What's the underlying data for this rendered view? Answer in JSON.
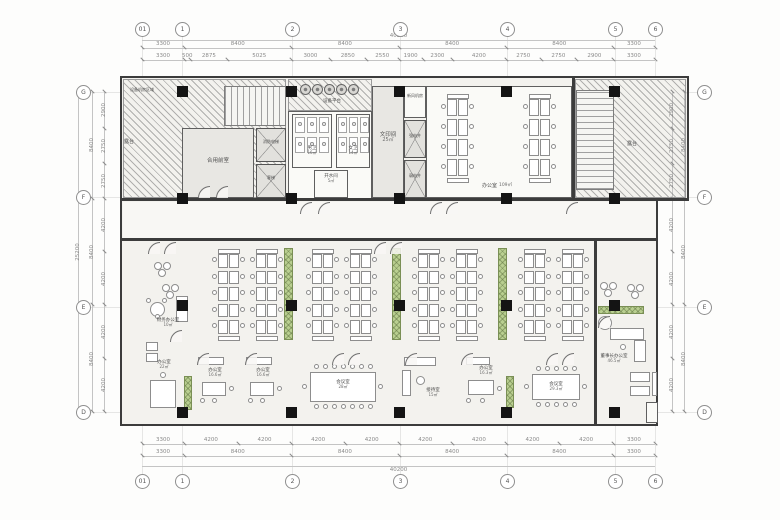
{
  "drawing": {
    "type_label": "办公平面布置图"
  },
  "grid": {
    "cols_labels": [
      "01",
      "1",
      "2",
      "3",
      "4",
      "5",
      "6"
    ],
    "rows_labels": [
      "G",
      "F",
      "E",
      "D"
    ]
  },
  "dims": {
    "overall_h": "40200",
    "overall_v": "25200",
    "top_spans": [
      "3300",
      "8400",
      "8400",
      "8400",
      "8400",
      "3300"
    ],
    "top_details": [
      "3300",
      "500",
      "2875",
      "5025",
      "3000",
      "2850",
      "2550",
      "1900",
      "2300",
      "4200",
      "2750",
      "2750",
      "2900",
      "3300"
    ],
    "bottom_spans": [
      "3300",
      "8400",
      "8400",
      "8400",
      "8400",
      "3300"
    ],
    "bottom_details": [
      "3300",
      "4200",
      "4200",
      "4200",
      "4200",
      "4200",
      "4200",
      "4200",
      "4200",
      "3300"
    ],
    "left_spans": [
      "8400",
      "8400",
      "8400"
    ],
    "left_details": [
      "2900",
      "2750",
      "2750",
      "4200",
      "4200",
      "4200",
      "4200"
    ],
    "right_spans": [
      "8400",
      "8400",
      "8400"
    ],
    "right_details": [
      "2900",
      "2750",
      "2750",
      "4200",
      "4200",
      "4200",
      "4200"
    ]
  },
  "rooms": {
    "shared_front": {
      "name": "合用前室",
      "area": "32㎡"
    },
    "terrace_left": {
      "name": "露台"
    },
    "terrace_right": {
      "name": "露台"
    },
    "equip_zone": {
      "name": "设备机房区域"
    },
    "equip_platform": {
      "name": "设备平台"
    },
    "mens_wc": {
      "name": "男卫",
      "area": "16㎡"
    },
    "womens_wc": {
      "name": "女卫",
      "area": "14㎡"
    },
    "water_room": {
      "name": "开水间",
      "area": "5㎡"
    },
    "print_room": {
      "name": "文印间",
      "area": "25㎡"
    },
    "fresh_air": {
      "name": "新风机房"
    },
    "strong_shaft": {
      "name": "强电井"
    },
    "weak_shaft": {
      "name": "弱电井"
    },
    "elevator_fire": {
      "name": "消防电梯"
    },
    "elevator_passenger": {
      "name": "客梯"
    },
    "office_top": {
      "name": "办公室",
      "area": "109㎡"
    },
    "finance_office": {
      "name": "财务办公室",
      "area": "10㎡"
    },
    "office_22": {
      "name": "办公室",
      "area": "22㎡"
    },
    "office_166a": {
      "name": "办公室",
      "area": "16.6㎡"
    },
    "office_166b": {
      "name": "办公室",
      "area": "16.6㎡"
    },
    "meeting_28": {
      "name": "会议室",
      "area": "28㎡"
    },
    "reception": {
      "name": "接待室",
      "area": "15㎡"
    },
    "office_163": {
      "name": "办公室",
      "area": "16.3㎡"
    },
    "meeting_293": {
      "name": "会议室",
      "area": "29.3㎡"
    },
    "chairman_office": {
      "name": "董事长办公室",
      "area": "46.5㎡"
    }
  },
  "colors": {
    "glass_teal": "#2e99a1",
    "meeting_blue": "#9dc7ce",
    "wood_floor": "#c6a37b",
    "chairman_wood": "#b18a62",
    "cabinet_green": "#b9cf90"
  }
}
